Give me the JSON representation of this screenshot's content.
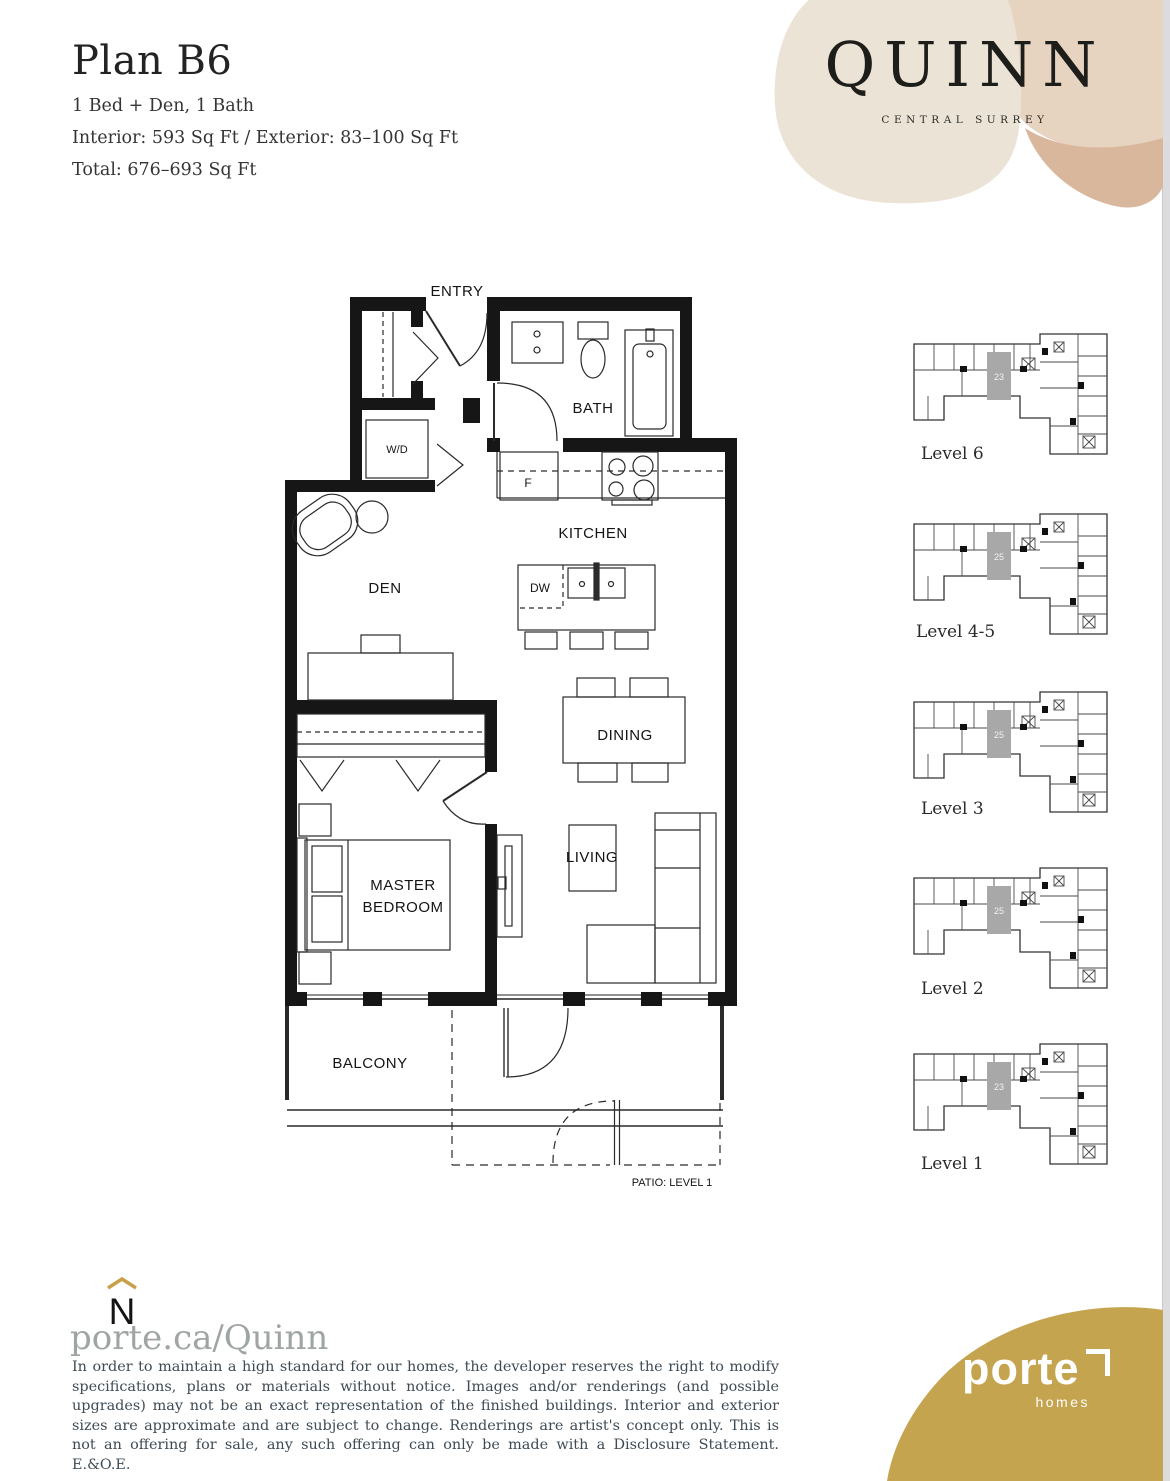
{
  "header": {
    "title": "Plan B6",
    "spec_line1": "1 Bed + Den, 1 Bath",
    "spec_line2": "Interior: 593 Sq Ft  /  Exterior: 83–100 Sq Ft",
    "spec_line3": "Total: 676–693 Sq Ft"
  },
  "brand": {
    "name": "QUINN",
    "tagline": "CENTRAL SURREY"
  },
  "floorplan": {
    "labels": {
      "entry": "ENTRY",
      "bath": "BATH",
      "wd": "W/D",
      "fridge": "F",
      "kitchen": "KITCHEN",
      "den": "DEN",
      "dw": "DW",
      "dining": "DINING",
      "living": "LIVING",
      "master_line1": "MASTER",
      "master_line2": "BEDROOM",
      "balcony": "BALCONY",
      "patio": "PATIO: LEVEL 1"
    }
  },
  "keyplans": [
    {
      "label": "Level 6",
      "unit": "23"
    },
    {
      "label": "Level 4-5",
      "unit": "25"
    },
    {
      "label": "Level 3",
      "unit": "25"
    },
    {
      "label": "Level 2",
      "unit": "25"
    },
    {
      "label": "Level 1",
      "unit": "23"
    }
  ],
  "footer": {
    "compass": "N",
    "website": "porte.ca/Quinn",
    "disclaimer": "In order to maintain a high standard for our homes, the developer reserves the right to modify specifications, plans or materials without notice. Images and/or renderings (and possible upgrades) may not be an exact representation of the finished buildings. Interior and exterior sizes are approximate and are subject to change. Renderings are artist's concept only. This is not an offering for sale, any such offering can only be made with a Disclosure Statement. E.&O.E.",
    "logo_name": "porte",
    "logo_sub": "homes"
  },
  "colors": {
    "accent_gold": "#c5a44f",
    "blob_cream": "#ebe4d6",
    "blob_tan": "#e6d3c0",
    "blob_rose": "#d9b79c",
    "highlight_gray": "#a8a8a8",
    "website_gray": "#9fa5a2",
    "disclaimer_text": "#3e4b54"
  }
}
